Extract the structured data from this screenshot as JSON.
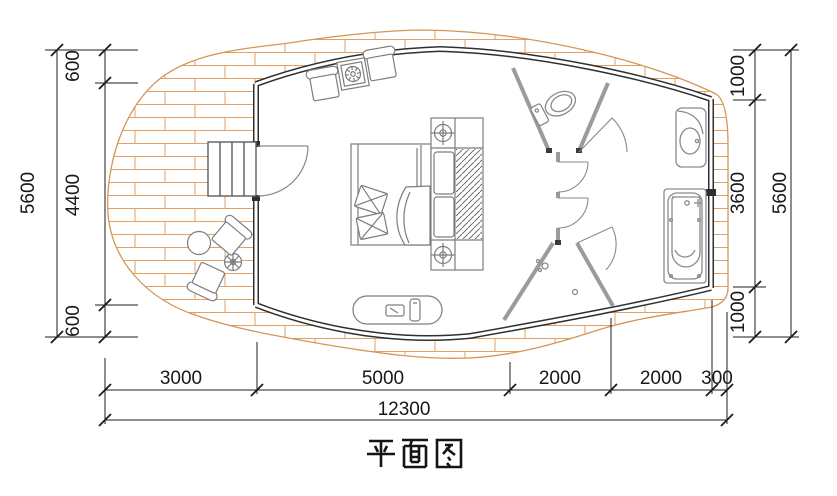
{
  "title": "平面图",
  "dimensions": {
    "left": {
      "total": "5600",
      "segments": [
        "600",
        "4400",
        "600"
      ]
    },
    "right": {
      "total": "5600",
      "segments": [
        "1000",
        "3600",
        "1000"
      ]
    },
    "bottom": {
      "total": "12300",
      "segments": [
        "3000",
        "5000",
        "2000",
        "2000",
        "300"
      ]
    }
  },
  "colors": {
    "wall": "#2f2f2f",
    "partition": "#9b9b9b",
    "deck_plank": "#e2a064",
    "furniture_line": "#7d7d7d",
    "dimension_line": "#1c1c1c"
  }
}
